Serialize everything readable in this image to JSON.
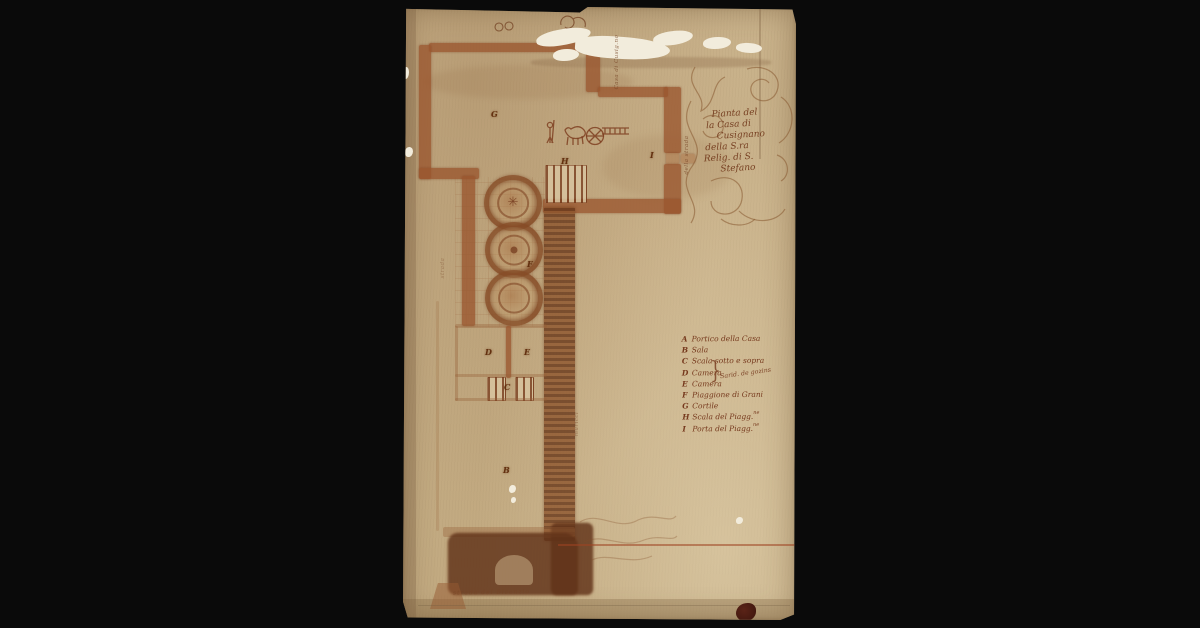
{
  "artifact": {
    "kind": "antique manuscript floor plan, ink on aged paper",
    "background_color": "#0a0a0a",
    "paper_color": "#c9b28b",
    "ink_color": "#8a4a28"
  },
  "cartouche": {
    "lines": [
      "Pianta del",
      "la Casa di",
      "Cusignano",
      "della S.ra",
      "Relig. di S.",
      "Stefano"
    ]
  },
  "legend": {
    "rows": [
      {
        "letter": "A",
        "text": "Portico della Casa",
        "sup": ""
      },
      {
        "letter": "B",
        "text": "Sala",
        "sup": ""
      },
      {
        "letter": "C",
        "text": "Scala sotto e sopra",
        "sup": ""
      },
      {
        "letter": "D",
        "text": "Camera",
        "sup": ""
      },
      {
        "letter": "E",
        "text": "Camera",
        "sup": ""
      },
      {
        "letter": "F",
        "text": "Piaggione di Grani",
        "sup": ""
      },
      {
        "letter": "G",
        "text": "Cortile",
        "sup": ""
      },
      {
        "letter": "H",
        "text": "Scala del Piagg.",
        "sup": "ne"
      },
      {
        "letter": "I",
        "text": "Porta del Piagg.",
        "sup": "ne"
      }
    ],
    "brace": "}",
    "brace_note": "Sarid. de gozins"
  },
  "plan": {
    "letters": [
      {
        "char": "G"
      },
      {
        "char": "H"
      },
      {
        "char": "I"
      },
      {
        "char": "F"
      },
      {
        "char": "D"
      },
      {
        "char": "E"
      },
      {
        "char": "C"
      },
      {
        "char": "B"
      }
    ]
  },
  "inscriptions": {
    "top_vertical": "Casa di Cusig.no",
    "wall_vertical": "della strada",
    "left_vertical": "strada",
    "corridor_vertical": "muricci",
    "bottom": "strada del Bisenzio"
  }
}
